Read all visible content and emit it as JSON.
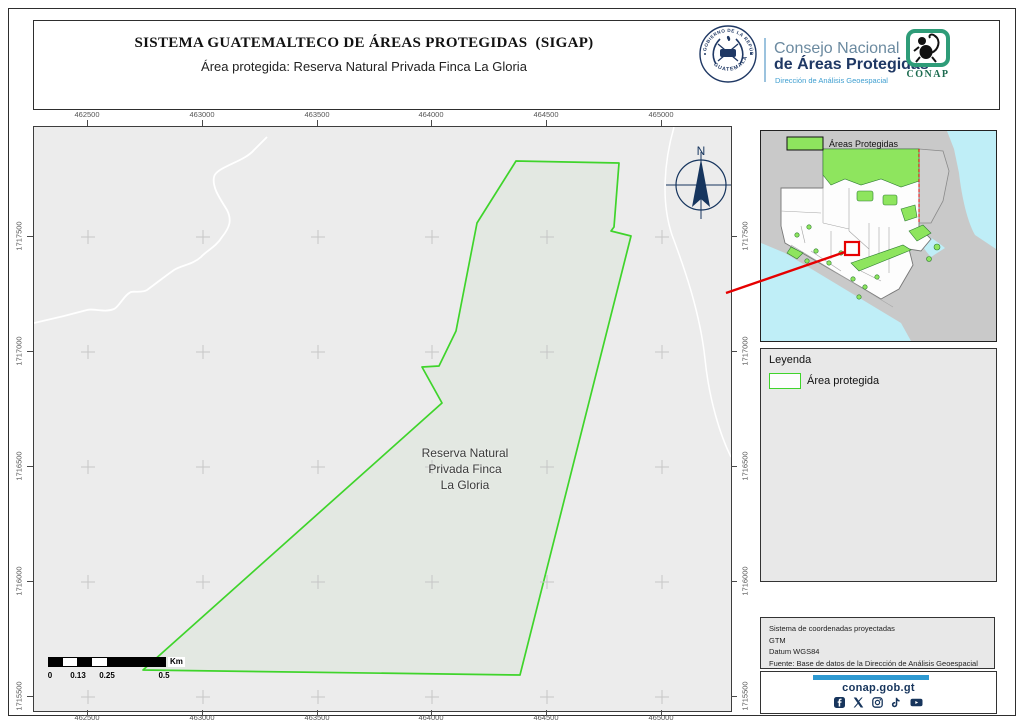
{
  "header": {
    "title": "SISTEMA GUATEMALTECO DE ÁREAS PROTEGIDAS  (SIGAP)",
    "subtitle": "Área protegida: Reserva Natural Privada Finca La Gloria",
    "gov_seal": {
      "top": "GOBIERNO DE LA REPÚBLICA",
      "bottom": "GUATEMALA"
    },
    "org": {
      "line1": "Consejo Nacional",
      "line2": "de Áreas Protegidas",
      "line3": "Dirección de Análisis Geoespacial"
    },
    "conap_label": "CONAP"
  },
  "map": {
    "area_label_lines": [
      "Reserva Natural",
      "Privada Finca",
      "La Gloria"
    ],
    "north_label": "N",
    "x_ticks": [
      "462500",
      "463000",
      "463500",
      "464000",
      "464500",
      "465000"
    ],
    "y_ticks": [
      "1717500",
      "1717000",
      "1716500",
      "1716000",
      "1715500"
    ],
    "scalebar": {
      "labels": [
        "0",
        "0.13",
        "0.25",
        "0.5"
      ],
      "unit": "Km"
    }
  },
  "inset": {
    "legend_label": "Áreas Protegidas"
  },
  "legend": {
    "title": "Leyenda",
    "item_label": "Área protegida"
  },
  "metadata": {
    "lines": [
      "Sistema de coordenadas proyectadas",
      "GTM",
      "Datum WGS84",
      "Fuente: Base de datos de la Dirección de Análisis Geoespacial"
    ]
  },
  "footer": {
    "website": "conap.gob.gt",
    "social_icons": [
      "facebook-icon",
      "x-icon",
      "instagram-icon",
      "tiktok-icon",
      "youtube-icon"
    ]
  },
  "colors": {
    "protected_outline": "#3fd42b",
    "protected_fill": "#e3e8e2",
    "map_background": "#ececec",
    "inset_green": "#8ee55e",
    "navy": "#1f3864",
    "red_marker": "#e60000",
    "footer_bar_blue": "#2f9ad2"
  }
}
